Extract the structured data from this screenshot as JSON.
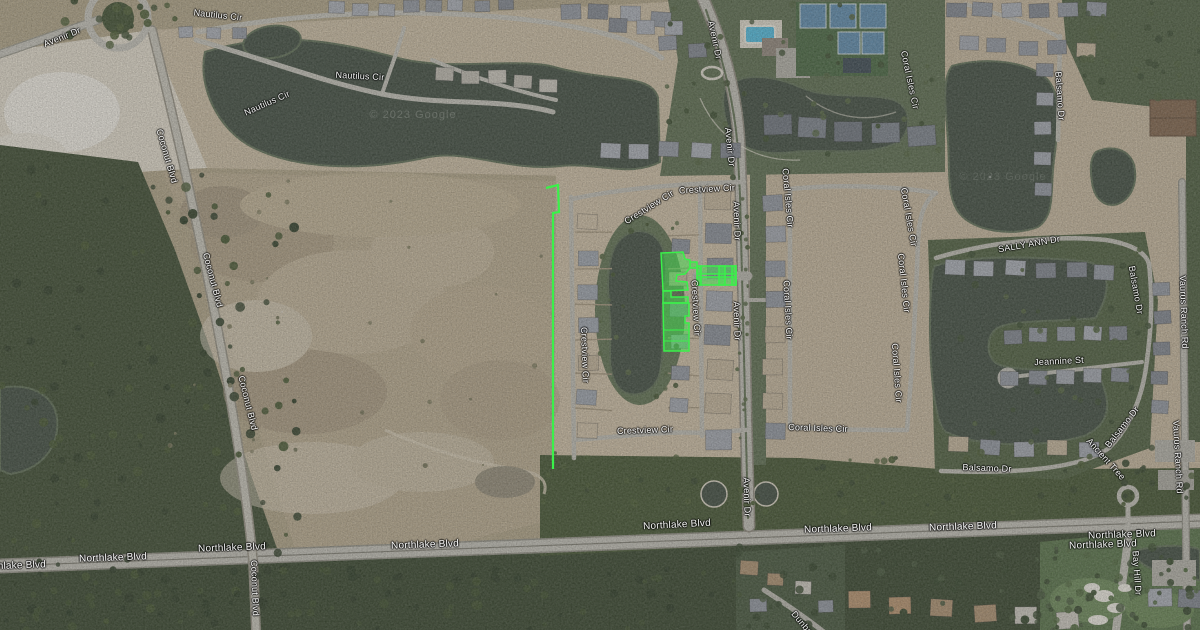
{
  "map": {
    "imagery_type": "satellite",
    "attribution_watermarks": [
      {
        "text": "© 2023 Google",
        "x": 413,
        "y": 115,
        "opacity": 0.2
      },
      {
        "text": "© 2023 Google",
        "x": 1003,
        "y": 177,
        "opacity": 0.13
      }
    ],
    "road_labels": [
      {
        "text": "Avenir Dr",
        "x": 62,
        "y": 37,
        "rot": -22
      },
      {
        "text": "Nautilus Cir",
        "x": 218,
        "y": 15,
        "rot": 6
      },
      {
        "text": "Nautilus Cir",
        "x": 267,
        "y": 103,
        "rot": -24
      },
      {
        "text": "Nautilus Cir",
        "x": 360,
        "y": 76,
        "rot": 3
      },
      {
        "text": "Coconut Blvd",
        "x": 167,
        "y": 156,
        "rot": 74
      },
      {
        "text": "Coconut Blvd",
        "x": 213,
        "y": 280,
        "rot": 75
      },
      {
        "text": "Coconut Blvd",
        "x": 248,
        "y": 403,
        "rot": 76
      },
      {
        "text": "Coconut Blvd",
        "x": 255,
        "y": 588,
        "rot": 88
      },
      {
        "text": "Avenir Dr",
        "x": 715,
        "y": 40,
        "rot": 78
      },
      {
        "text": "Avenir Dr",
        "x": 730,
        "y": 147,
        "rot": 84
      },
      {
        "text": "Avenir Dr",
        "x": 737,
        "y": 221,
        "rot": 88
      },
      {
        "text": "Avenir Dr",
        "x": 737,
        "y": 321,
        "rot": 88
      },
      {
        "text": "Avenir Dr",
        "x": 747,
        "y": 497,
        "rot": 88
      },
      {
        "text": "Crestview Cir",
        "x": 707,
        "y": 189,
        "rot": -3
      },
      {
        "text": "Crestview Cir",
        "x": 649,
        "y": 207,
        "rot": -32
      },
      {
        "text": "Crestview Cir",
        "x": 696,
        "y": 308,
        "rot": 87
      },
      {
        "text": "Crestview Cir",
        "x": 585,
        "y": 355,
        "rot": 88
      },
      {
        "text": "Crestview Cir",
        "x": 645,
        "y": 430,
        "rot": -2
      },
      {
        "text": "Coral Isles Cir",
        "x": 788,
        "y": 198,
        "rot": 85
      },
      {
        "text": "Coral Isles Cir",
        "x": 788,
        "y": 310,
        "rot": 87
      },
      {
        "text": "Coral Isles Cir",
        "x": 910,
        "y": 80,
        "rot": 78
      },
      {
        "text": "Coral Isles Cir",
        "x": 909,
        "y": 217,
        "rot": 80
      },
      {
        "text": "Coral Isles Cir",
        "x": 904,
        "y": 283,
        "rot": 84
      },
      {
        "text": "Coral Isles Cir",
        "x": 897,
        "y": 373,
        "rot": 86
      },
      {
        "text": "Coral Isles Cir",
        "x": 818,
        "y": 428,
        "rot": 2
      },
      {
        "text": "SALLY ANN Dr",
        "x": 1029,
        "y": 244,
        "rot": -10
      },
      {
        "text": "Jeannine St",
        "x": 1059,
        "y": 361,
        "rot": -3
      },
      {
        "text": "Balsamo Dr",
        "x": 1060,
        "y": 96,
        "rot": 86
      },
      {
        "text": "Balsamo Dr",
        "x": 1136,
        "y": 290,
        "rot": 80
      },
      {
        "text": "Balsamo Dr",
        "x": 1122,
        "y": 427,
        "rot": -52
      },
      {
        "text": "Balsamo Dr",
        "x": 987,
        "y": 468,
        "rot": 2
      },
      {
        "text": "Ancient Tree",
        "x": 1106,
        "y": 459,
        "rot": 48
      },
      {
        "text": "Vaurus Ranch Rd",
        "x": 1184,
        "y": 312,
        "rot": 88
      },
      {
        "text": "Vaurus Ranch Rd",
        "x": 1178,
        "y": 457,
        "rot": 87
      },
      {
        "text": "Bay Hill Dr",
        "x": 1137,
        "y": 573,
        "rot": 86
      },
      {
        "text": "Dunbar",
        "x": 803,
        "y": 624,
        "rot": 50
      },
      {
        "text": "Northlake Blvd",
        "x": 12,
        "y": 566,
        "rot": -2,
        "major": true
      },
      {
        "text": "Northlake Blvd",
        "x": 113,
        "y": 558,
        "rot": -2,
        "major": true
      },
      {
        "text": "Northlake Blvd",
        "x": 232,
        "y": 548,
        "rot": -2,
        "major": true
      },
      {
        "text": "Northlake Blvd",
        "x": 425,
        "y": 545,
        "rot": -2,
        "major": true
      },
      {
        "text": "Northlake Blvd",
        "x": 677,
        "y": 525,
        "rot": -3,
        "major": true
      },
      {
        "text": "Northlake Blvd",
        "x": 838,
        "y": 529,
        "rot": -2,
        "major": true
      },
      {
        "text": "Northlake Blvd",
        "x": 963,
        "y": 527,
        "rot": -2,
        "major": true
      },
      {
        "text": "Northlake Blvd",
        "x": 1103,
        "y": 545,
        "rot": -2,
        "major": true
      },
      {
        "text": "Northlake Blvd",
        "x": 1122,
        "y": 535,
        "rot": -2,
        "major": true
      }
    ],
    "highlights": {
      "stroke_color": "#3af04a",
      "fill_color": "rgba(62,232,78,0.45)",
      "items": [
        {
          "name": "western-boundary-line",
          "kind": "line",
          "width": 2.2,
          "d": "M546,188 L558,185 L559,212 L553,213 L553,469"
        },
        {
          "name": "parcel-north",
          "kind": "polygon",
          "d": "M661,253 L683,252 L685,259 L690,260 L690,268 L685,274 L677,275 L676,281 L687,282 L688,290 L663,291 Z"
        },
        {
          "name": "parcel-middle",
          "kind": "polygon",
          "d": "M663,291 L671,291 L671,297 L688,297 L688,303 L663,303 Z"
        },
        {
          "name": "parcel-south",
          "kind": "polygon",
          "d": "M663,303 L689,303 L689,316 L685,316 L685,323 L689,323 L689,351 L664,351 Z"
        },
        {
          "name": "parcel-road-link",
          "kind": "polygon",
          "d": "M690,262 L697,262 L697,268 L690,268 Z"
        },
        {
          "name": "entrance-road-north-bar",
          "kind": "polygon",
          "d": "M697,266 L736,266 L736,274 L697,274 Z"
        },
        {
          "name": "entrance-road-south-bar",
          "kind": "polygon",
          "d": "M697,277 L736,277 L736,285 L697,285 Z"
        },
        {
          "name": "entrance-road-west-connector",
          "kind": "polygon",
          "d": "M697,266 L701,266 L701,285 L697,285 Z"
        },
        {
          "name": "entrance-road-mid-connector",
          "kind": "polygon",
          "d": "M719,266 L725,266 L725,285 L719,285 Z"
        },
        {
          "name": "entrance-road-east-connector",
          "kind": "polygon",
          "d": "M732,266 L736,266 L736,285 L732,285 Z"
        },
        {
          "name": "parcel-south-lot-lines",
          "kind": "line",
          "width": 1,
          "d": "M664,330 L688,330 M664,341 L688,341"
        }
      ]
    }
  }
}
